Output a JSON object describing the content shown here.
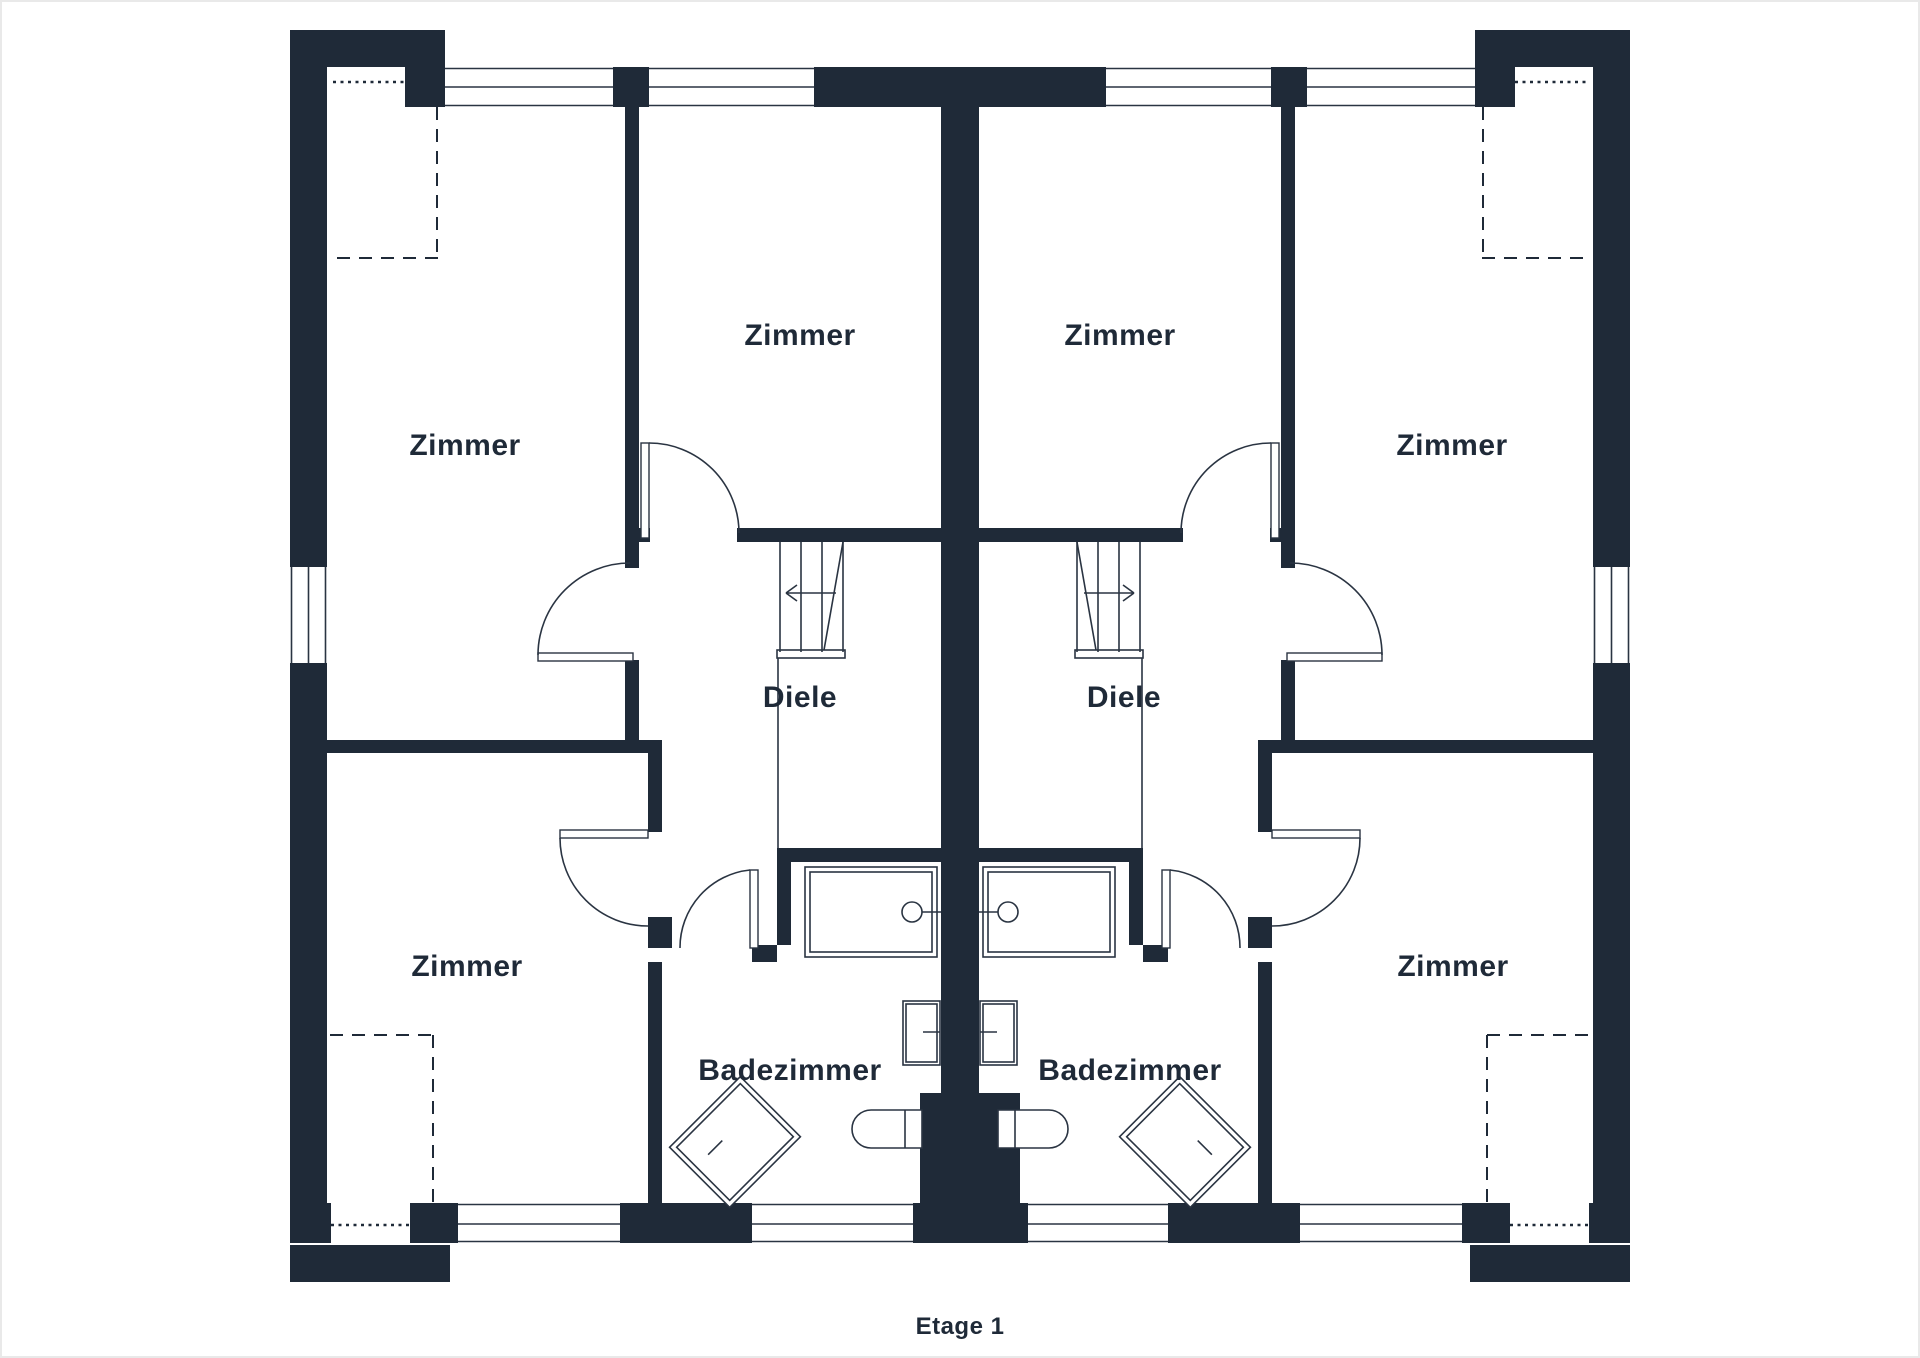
{
  "floor_label": "Etage 1",
  "colors": {
    "wall": "#1f2a38",
    "line": "#2a3442",
    "background": "#ffffff"
  },
  "unit_left": {
    "zimmer_nw": "Zimmer",
    "zimmer_n": "Zimmer",
    "diele": "Diele",
    "zimmer_sw": "Zimmer",
    "badezimmer": "Badezimmer"
  },
  "unit_right": {
    "zimmer_n": "Zimmer",
    "zimmer_ne": "Zimmer",
    "diele": "Diele",
    "zimmer_se": "Zimmer",
    "badezimmer": "Badezimmer"
  }
}
